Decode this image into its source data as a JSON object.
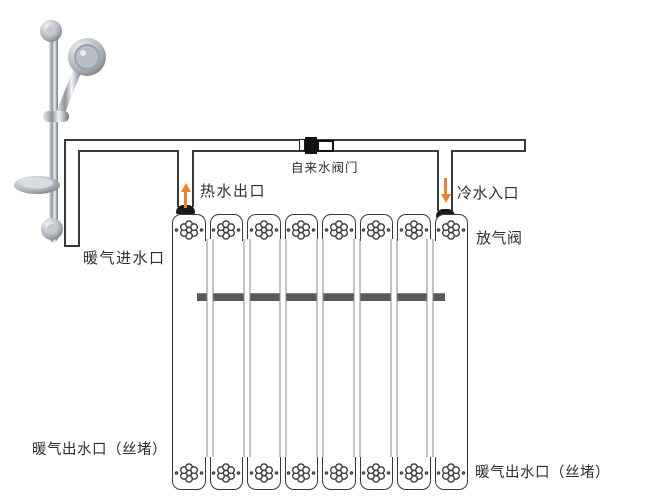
{
  "canvas": {
    "width": 655,
    "height": 499
  },
  "colors": {
    "line": "#3a3a3a",
    "arrow_orange": "#e8813a",
    "bar_gray": "#595959",
    "background": "#ffffff"
  },
  "labels": {
    "tap_water_valve": "自来水阀门",
    "hot_water_outlet": "热水出口",
    "cold_water_inlet": "冷水入口",
    "heating_inlet": "暖气进水口",
    "air_release_valve": "放气阀",
    "heating_outlet_left": "暖气出水口（丝堵）",
    "heating_outlet_right": "暖气出水口（丝堵）"
  },
  "radiator": {
    "sections": 8,
    "tubes": 7
  }
}
